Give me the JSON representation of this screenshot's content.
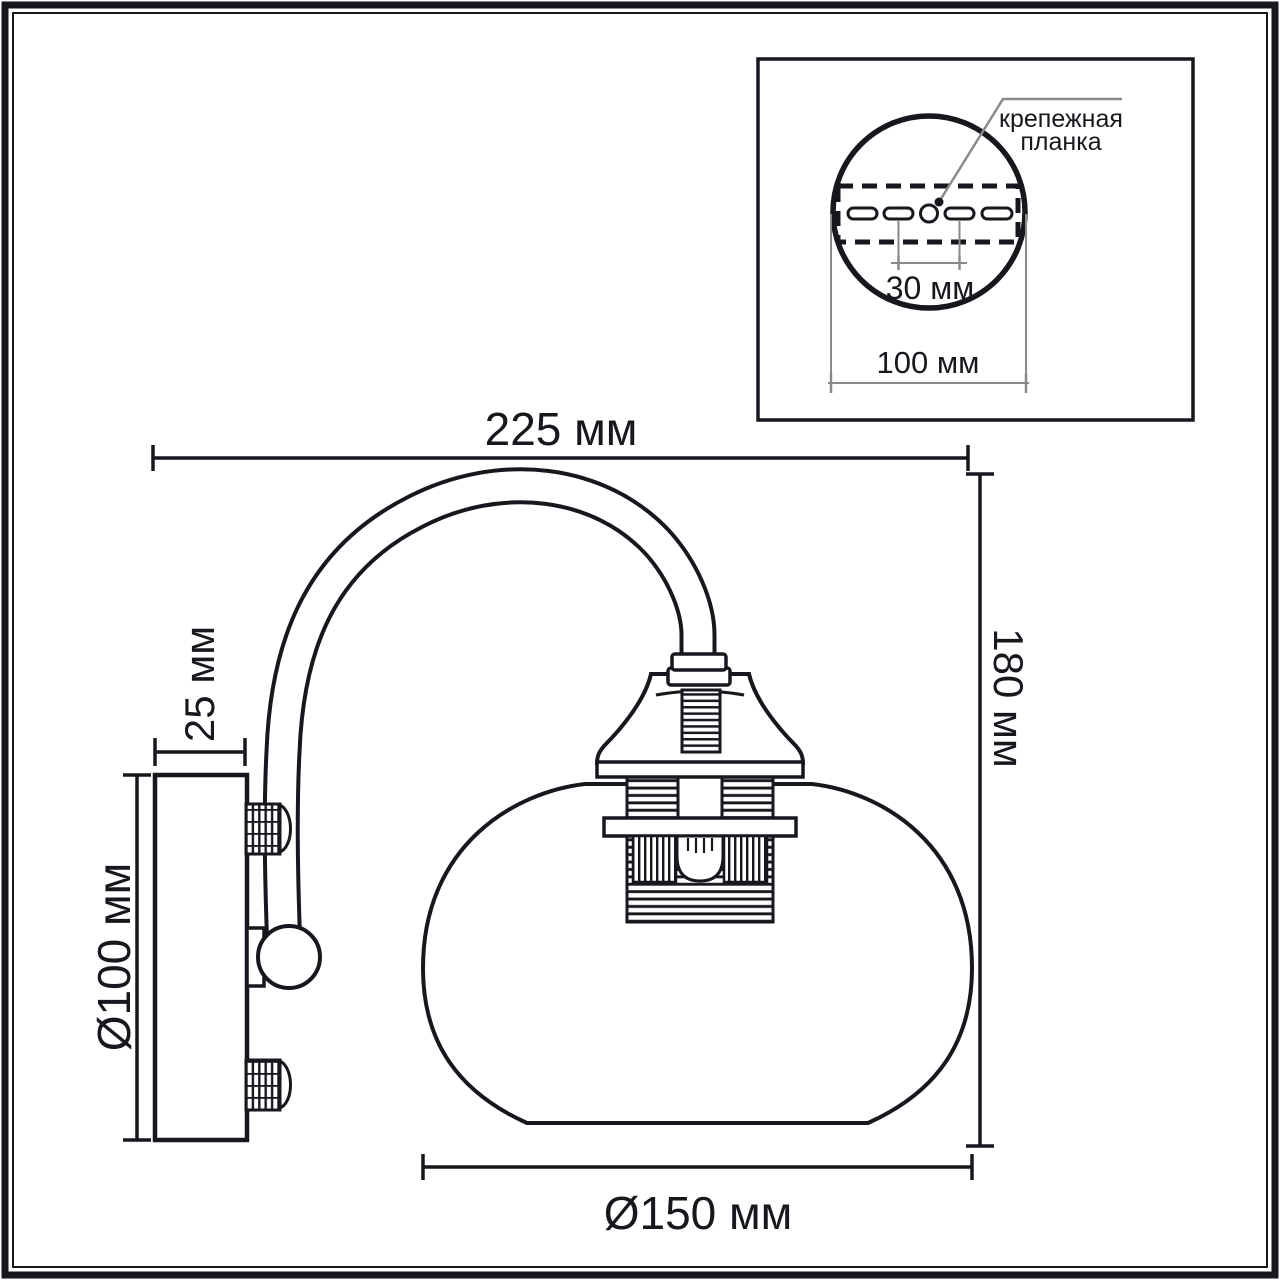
{
  "drawing": {
    "type": "technical dimension drawing of a wall sconce lamp",
    "background_color": "#ffffff",
    "line_color": "#17171e",
    "thin_line_color": "#8a8a8a"
  },
  "main_view": {
    "width_dim": "225 мм",
    "height_dim": "180 мм",
    "plate_depth_dim": "25 мм",
    "plate_diameter_dim": "Ø100 мм",
    "shade_diameter_dim": "Ø150 мм"
  },
  "inset": {
    "callout_line1": "крепежная",
    "callout_line2": "планка",
    "slot_spacing_dim": "30 мм",
    "plate_width_dim": "100 мм"
  }
}
